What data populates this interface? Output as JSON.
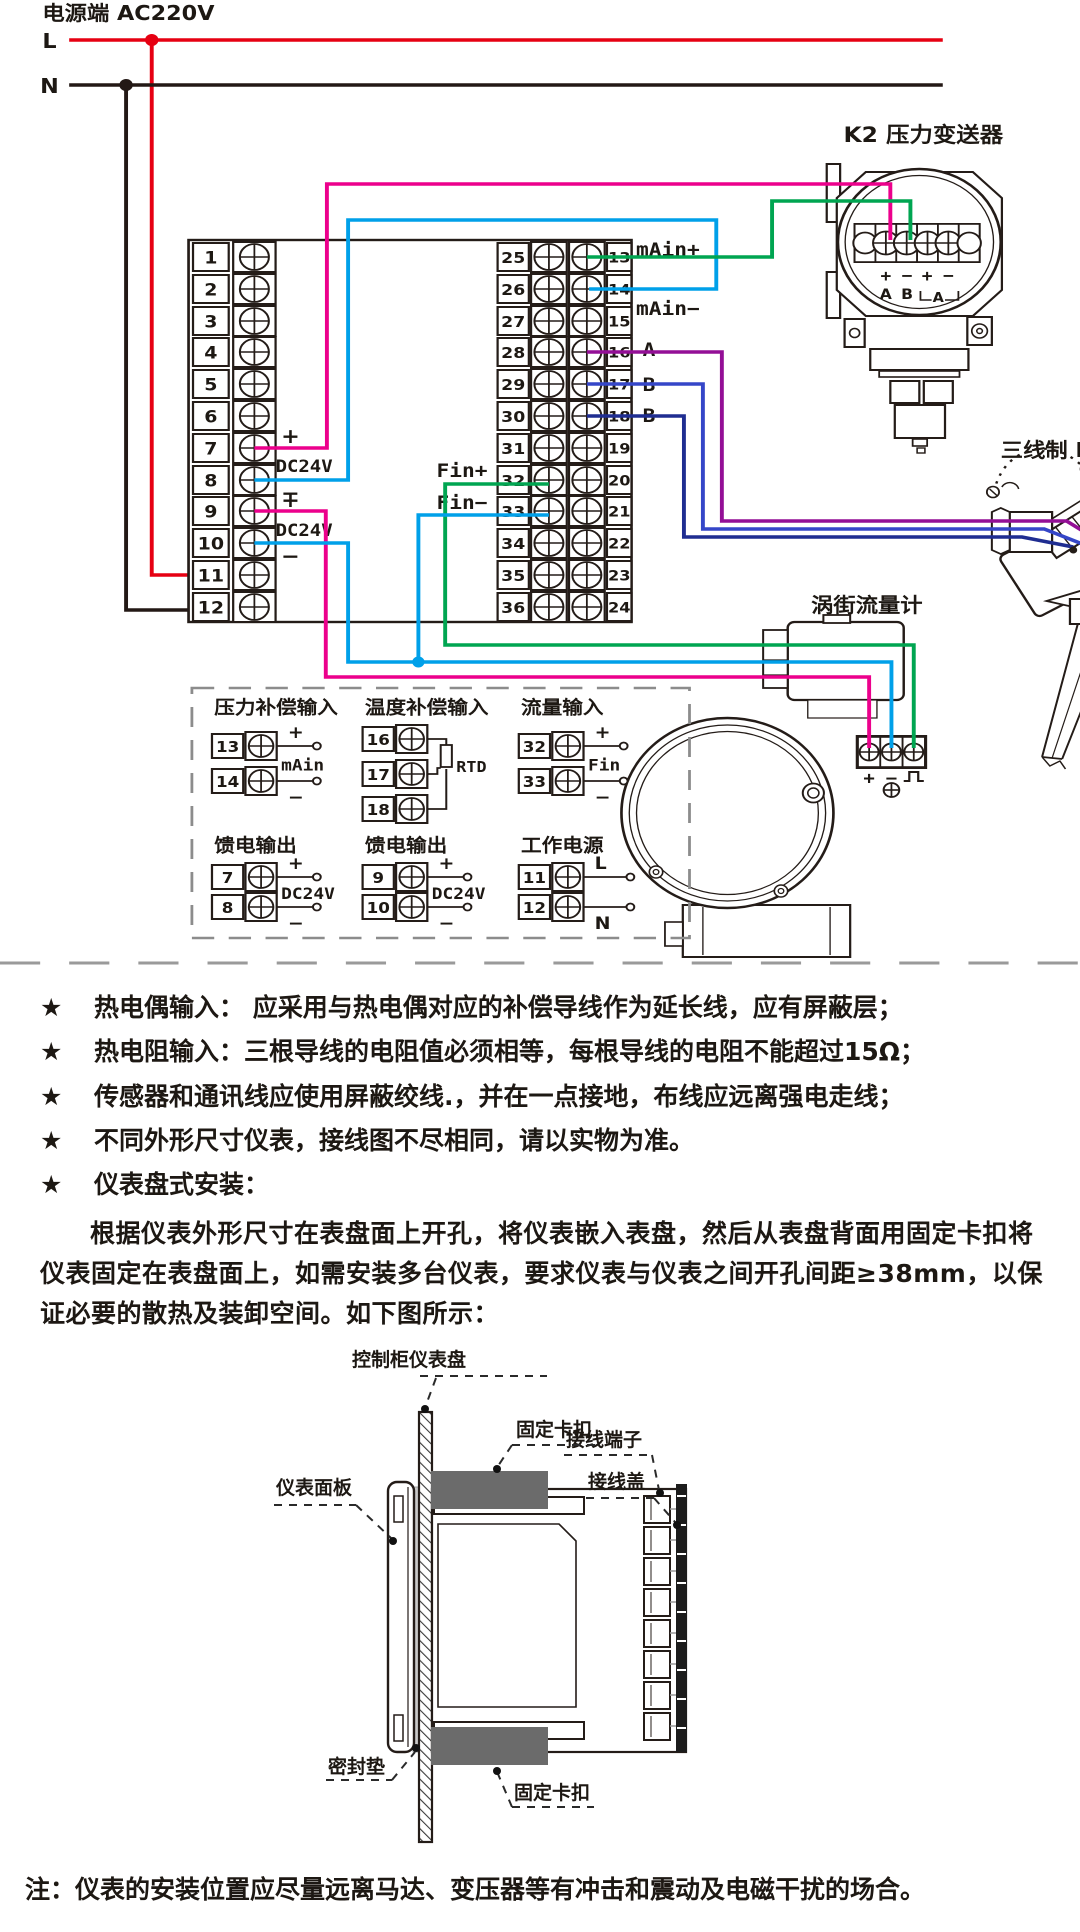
{
  "colors": {
    "live": "#e60012",
    "neutral": "#231815",
    "wire_pink": "#ec008c",
    "wire_cyan": "#00a0e9",
    "wire_green": "#00a551",
    "wire_purple": "#930f96",
    "wire_blue": "#3546c8",
    "wire_navy": "#1f2d91",
    "clip_gray": "#6b6b6b",
    "cover_dark": "#1c1c1c"
  },
  "power": {
    "title": "电源端 AC220V",
    "l": "L",
    "n": "N"
  },
  "terminal_strip": {
    "left_numbers": [
      "1",
      "2",
      "3",
      "4",
      "5",
      "6",
      "7",
      "8",
      "9",
      "10",
      "11",
      "12"
    ],
    "mid_left_numbers": [
      "25",
      "26",
      "27",
      "28",
      "29",
      "30",
      "31",
      "32",
      "33",
      "34",
      "35",
      "36"
    ],
    "mid_right_numbers": [
      "13",
      "14",
      "15",
      "16",
      "17",
      "18",
      "19",
      "20",
      "21",
      "22",
      "23",
      "24"
    ],
    "annotations": {
      "feed1": {
        "plus": "+",
        "label": "DC24V",
        "minus": "−"
      },
      "feed2": {
        "plus": "+",
        "label": "DC24V",
        "minus": "−"
      },
      "main_plus": "mAin+",
      "main_minus": "mAin−",
      "a": "A",
      "b1": "B",
      "b2": "B",
      "fin_plus": "Fin+",
      "fin_minus": "Fin−"
    }
  },
  "transmitter": {
    "title": "K2 压力变送器",
    "signs": [
      "+",
      "−",
      "+",
      "−"
    ],
    "letters": [
      "A",
      "B"
    ],
    "ammeter": "A"
  },
  "pt100": {
    "title": "三线制 PT100"
  },
  "flowmeter": {
    "title": "涡街流量计",
    "signs": [
      "+",
      "−",
      "⎍"
    ]
  },
  "detail_box": {
    "groups": [
      {
        "title": "压力补偿输入",
        "type": "two_wire",
        "mid_label": "mAin",
        "items": [
          {
            "no": "13",
            "tag": "+"
          },
          {
            "no": "14",
            "tag": "−"
          }
        ]
      },
      {
        "title": "温度补偿输入",
        "type": "rtd",
        "mid_label": "RTD",
        "items": [
          {
            "no": "16",
            "tag": ""
          },
          {
            "no": "17",
            "tag": ""
          },
          {
            "no": "18",
            "tag": ""
          }
        ]
      },
      {
        "title": "流量输入",
        "type": "two_wire",
        "mid_label": "Fin",
        "items": [
          {
            "no": "32",
            "tag": "+"
          },
          {
            "no": "33",
            "tag": "−"
          }
        ]
      },
      {
        "title": "馈电输出",
        "type": "two_wire",
        "mid_label": "DC24V",
        "items": [
          {
            "no": "7",
            "tag": "+"
          },
          {
            "no": "8",
            "tag": "−"
          }
        ]
      },
      {
        "title": "馈电输出",
        "type": "two_wire",
        "mid_label": "DC24V",
        "items": [
          {
            "no": "9",
            "tag": "+"
          },
          {
            "no": "10",
            "tag": "−"
          }
        ]
      },
      {
        "title": "工作电源",
        "type": "two_wire",
        "mid_label": "",
        "items": [
          {
            "no": "11",
            "tag": "L"
          },
          {
            "no": "12",
            "tag": "N"
          }
        ]
      }
    ]
  },
  "notes": {
    "star": "★",
    "bullets": [
      "热电偶输入： 应采用与热电偶对应的补偿导线作为延长线，应有屏蔽层；",
      "热电阻输入：三根导线的电阻值必须相等，每根导线的电阻不能超过15Ω；",
      "传感器和通讯线应使用屏蔽绞线.，并在一点接地，布线应远离强电走线；",
      "不同外形尺寸仪表，接线图不尽相同，请以实物为准。",
      "仪表盘式安装："
    ],
    "paragraph": "根据仪表外形尺寸在表盘面上开孔，将仪表嵌入表盘，然后从表盘背面用固定卡扣将仪表固定在表盘面上，如需安装多台仪表，要求仪表与仪表之间开孔间距≥38mm，以保证必要的散热及装卸空间。如下图所示："
  },
  "install": {
    "labels": {
      "panel": "控制柜仪表盘",
      "clip_top": "固定卡扣",
      "clip_bottom": "固定卡扣",
      "bezel": "仪表面板",
      "terminal_block": "接线端子",
      "cover": "接线盖",
      "gasket": "密封垫"
    }
  },
  "footer": {
    "note": "注：仪表的安装位置应尽量远离马达、变压器等有冲击和震动及电磁干扰的场合。"
  }
}
